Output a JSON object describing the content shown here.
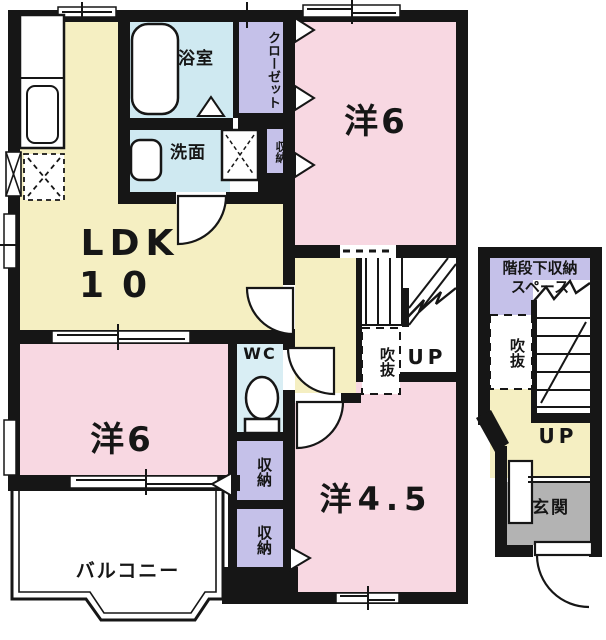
{
  "title": "2F floor plan (Japanese apartment)",
  "rooms": {
    "ldk": {
      "label": "LDK",
      "size": "10"
    },
    "western_top": {
      "label": "洋6"
    },
    "western_bottom": {
      "label": "洋6"
    },
    "western_45": {
      "label": "洋4.5"
    },
    "bath": {
      "label": "浴室"
    },
    "washroom": {
      "label": "洗面"
    },
    "wc": {
      "label": "WC"
    },
    "closet": {
      "label": "クローゼット"
    },
    "storage_top": {
      "label": "収納"
    },
    "storage_mid": {
      "label": "収納"
    },
    "storage_bottom": {
      "label": "収納"
    },
    "balcony": {
      "label": "バルコニー"
    },
    "entrance": {
      "label": "玄関"
    }
  },
  "stairwell": {
    "understairs_line1": "階段下収納",
    "understairs_line2": "スペース",
    "void_main": "吹抜",
    "void_annex": "吹抜",
    "up_main": "UP",
    "up_annex": "UP"
  },
  "colors": {
    "room_pink": "#f8d8e2",
    "room_yellow": "#f5efc2",
    "room_blue": "#cfe9f1",
    "room_purple": "#c5c1e9",
    "entrance_gray": "#b3b3b3",
    "wall_black": "#161616"
  }
}
